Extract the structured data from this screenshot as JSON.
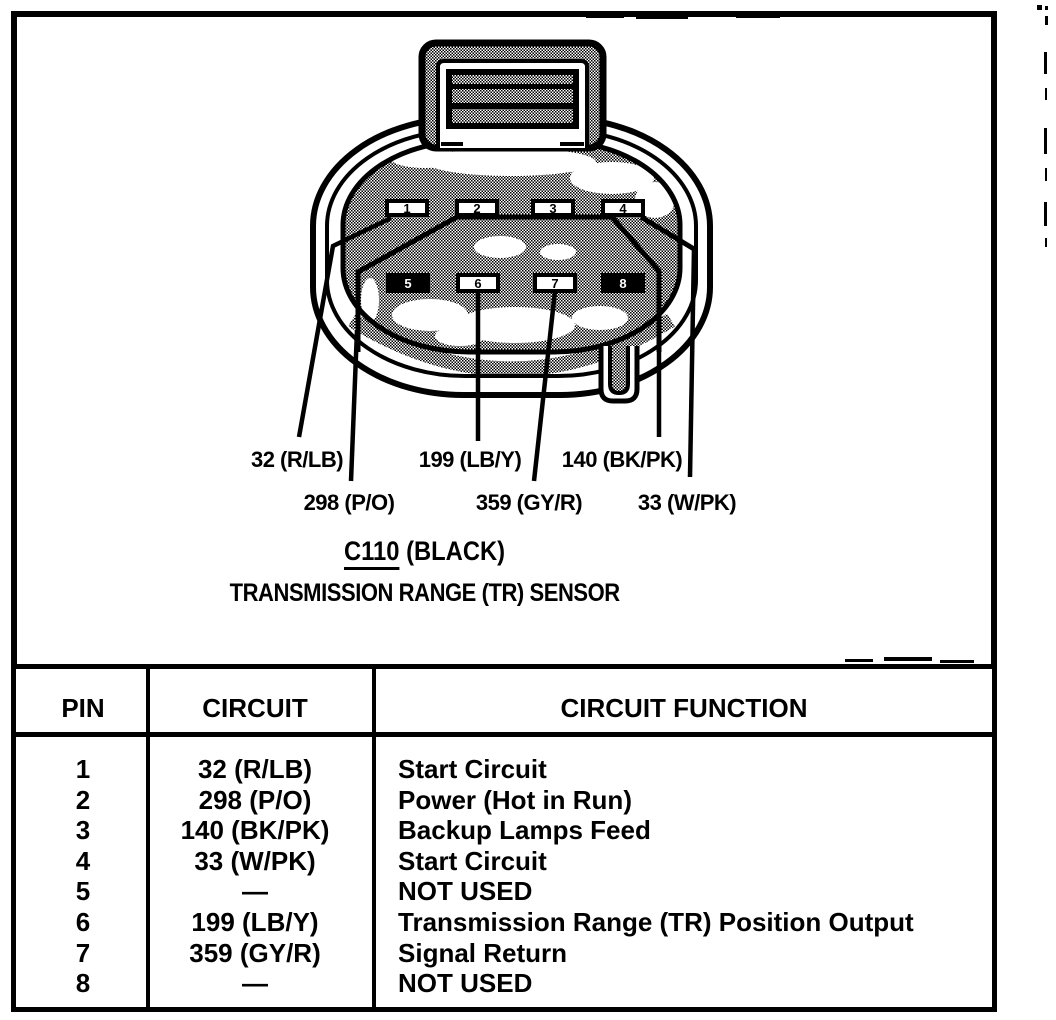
{
  "diagram": {
    "connector_id": "C110",
    "connector_color_suffix": " (BLACK)",
    "subtitle": "TRANSMISSION RANGE (TR) SENSOR",
    "pins": [
      "1",
      "2",
      "3",
      "4",
      "5",
      "6",
      "7",
      "8"
    ],
    "wire_labels": [
      "32 (R/LB)",
      "199 (LB/Y)",
      "140 (BK/PK)",
      "298 (P/O)",
      "359 (GY/R)",
      "33 (W/PK)"
    ]
  },
  "table": {
    "headers": {
      "pin": "PIN",
      "circuit": "CIRCUIT",
      "function": "CIRCUIT FUNCTION"
    },
    "rows": [
      {
        "pin": "1",
        "circuit": "32 (R/LB)",
        "function": "Start Circuit"
      },
      {
        "pin": "2",
        "circuit": "298 (P/O)",
        "function": "Power (Hot in Run)"
      },
      {
        "pin": "3",
        "circuit": "140 (BK/PK)",
        "function": "Backup Lamps Feed"
      },
      {
        "pin": "4",
        "circuit": "33 (W/PK)",
        "function": "Start Circuit"
      },
      {
        "pin": "5",
        "circuit": "—",
        "function": "NOT USED"
      },
      {
        "pin": "6",
        "circuit": "199 (LB/Y)",
        "function": "Transmission Range (TR) Position Output"
      },
      {
        "pin": "7",
        "circuit": "359 (GY/R)",
        "function": "Signal Return"
      },
      {
        "pin": "8",
        "circuit": "—",
        "function": "NOT USED"
      }
    ]
  },
  "colors": {
    "ink": "#000000",
    "paper": "#ffffff"
  }
}
